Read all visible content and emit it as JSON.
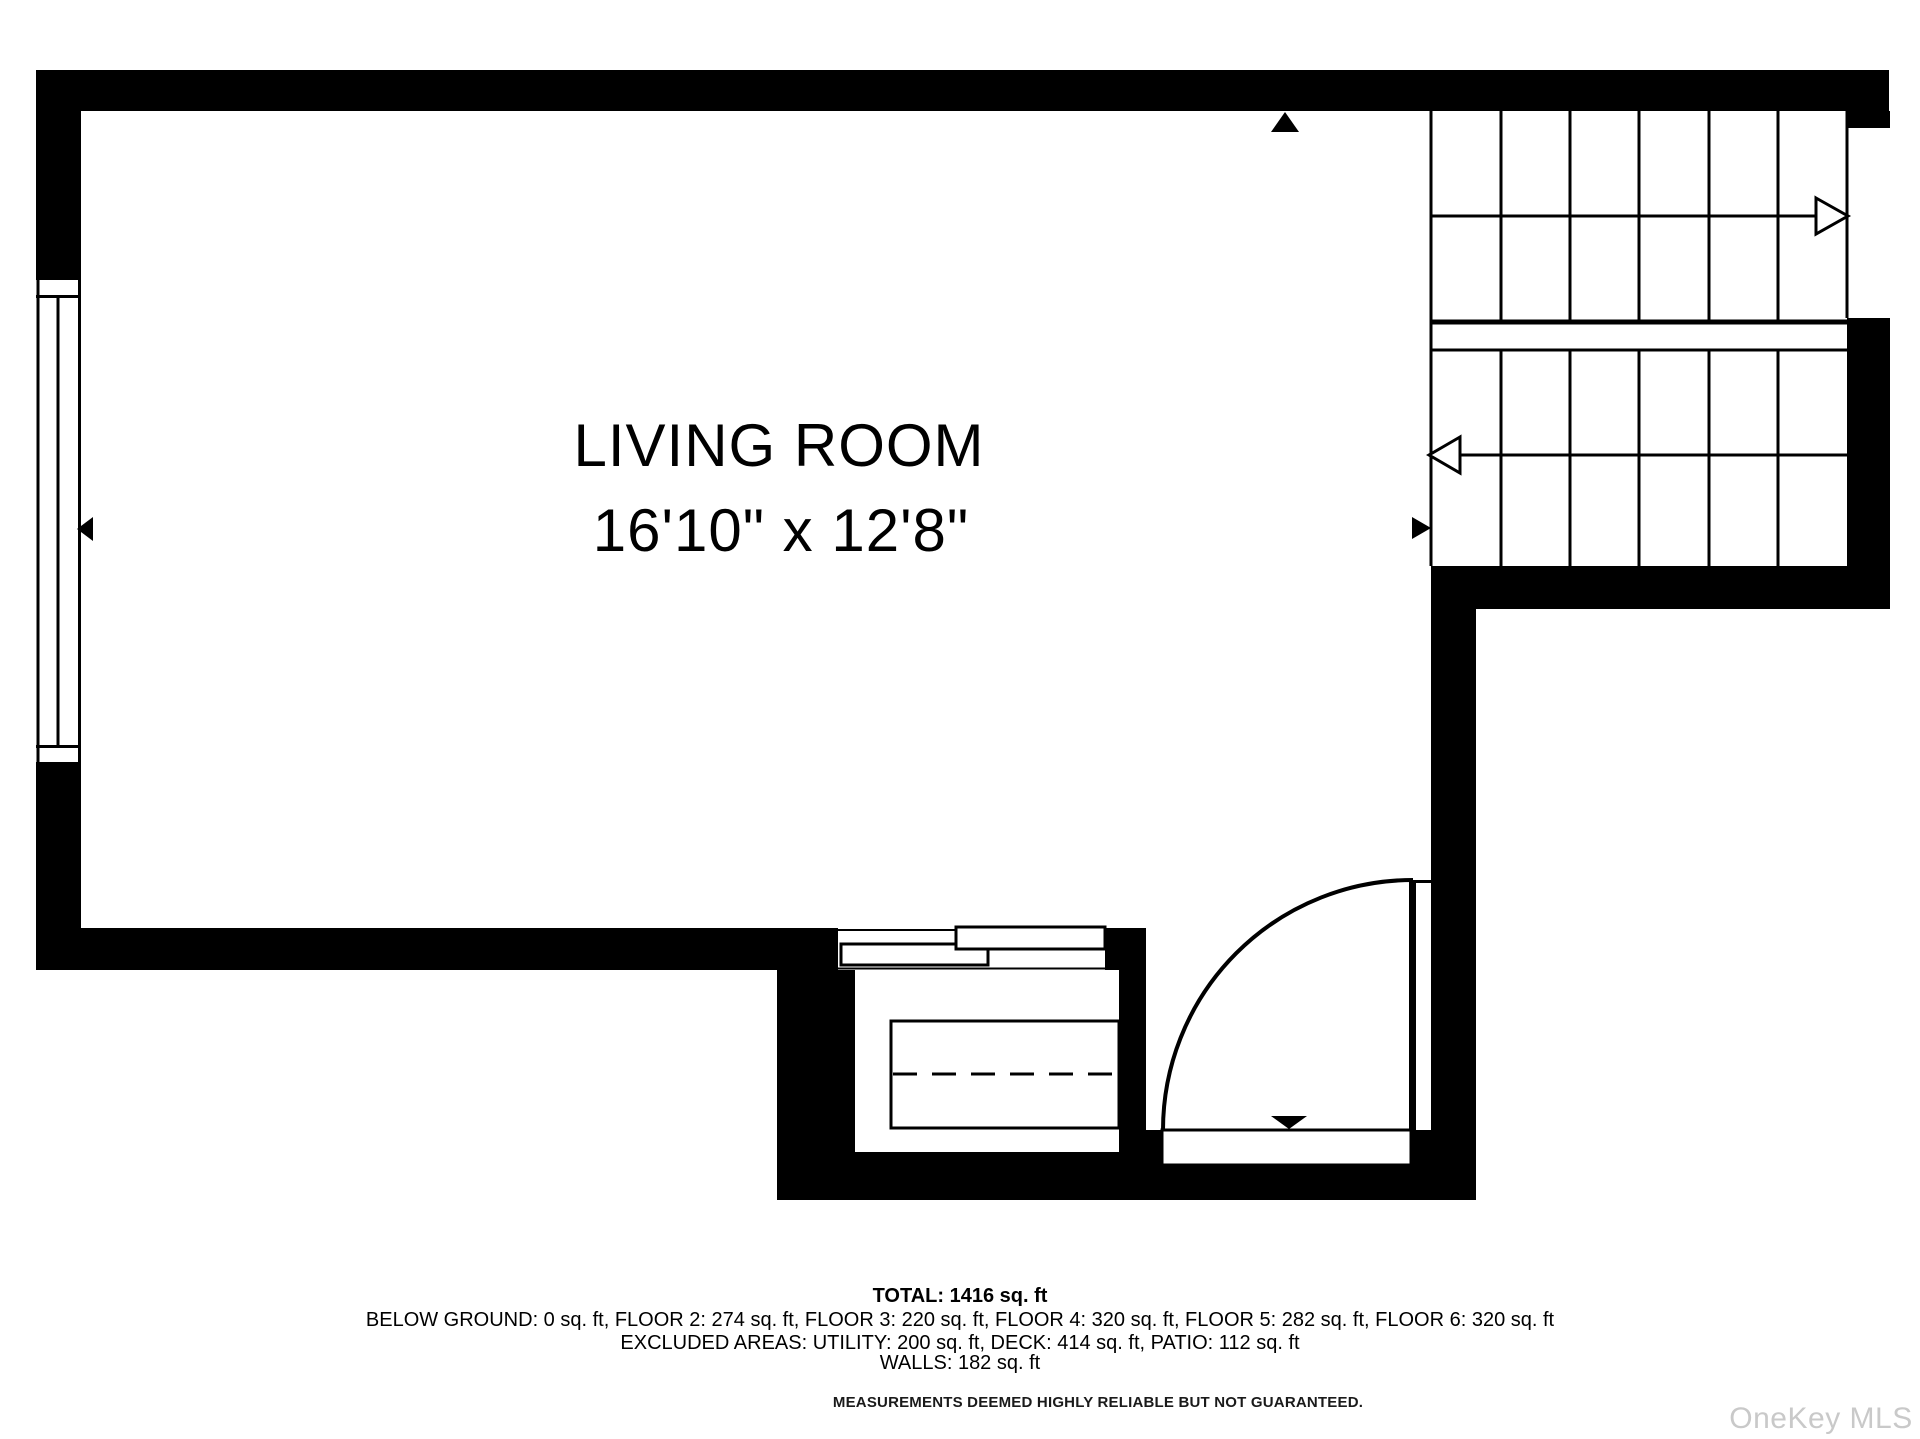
{
  "room": {
    "name": "LIVING ROOM",
    "dimensions": "16'10\" x 12'8\""
  },
  "summary": {
    "total": "TOTAL: 1416 sq. ft",
    "floors": "BELOW GROUND: 0 sq. ft, FLOOR 2: 274 sq. ft, FLOOR 3: 220 sq. ft, FLOOR 4: 320 sq. ft, FLOOR 5: 282 sq. ft, FLOOR 6: 320 sq. ft",
    "excluded": "EXCLUDED AREAS: UTILITY: 200 sq. ft, DECK: 414 sq. ft, PATIO: 112 sq. ft",
    "walls": "WALLS: 182 sq. ft"
  },
  "disclaimer": "MEASUREMENTS DEEMED HIGHLY RELIABLE BUT NOT GUARANTEED.",
  "watermark": "OneKey MLS",
  "colors": {
    "wall": "#000000",
    "line": "#000000",
    "background": "#ffffff",
    "watermark": "#c9c9c9"
  },
  "symbols": {
    "stair_up_arrow": "open-arrow-right",
    "stair_down_arrow": "open-arrow-left",
    "door_swing": "quarter-circle-arc",
    "window_marker": "filled-triangle-left",
    "top_wall_marker": "filled-triangle-up",
    "stair_entry_marker": "filled-triangle-right",
    "door_threshold_marker": "filled-triangle-down",
    "closet_sliding_door": "bypass-panels",
    "closet_shelf": "dashed-rod-rectangle"
  }
}
